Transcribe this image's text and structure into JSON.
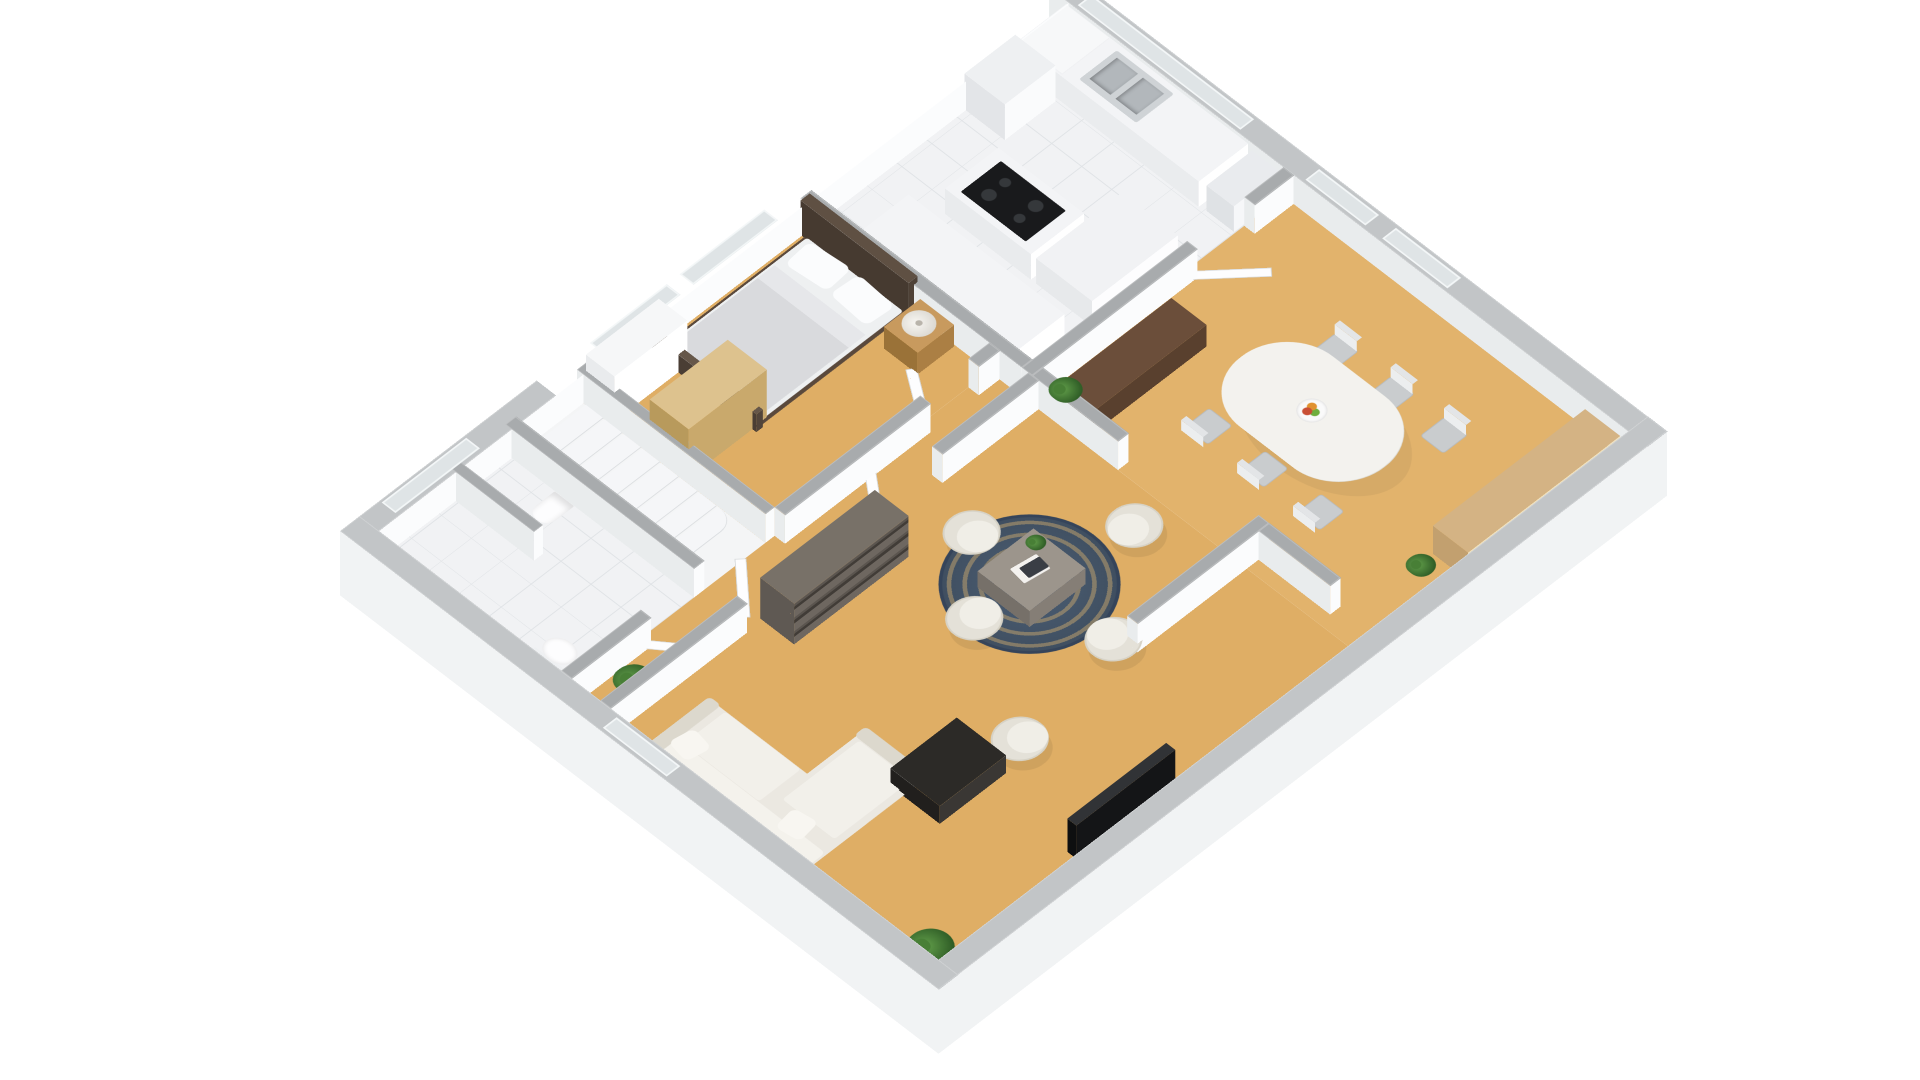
{
  "meta": {
    "view": "isometric-3d-floor-plan",
    "background": "#ffffff"
  },
  "palette": {
    "wood": "#dfae65",
    "wood2": "#e2b36c",
    "tile": "#f1f2f4",
    "tile_line": "#e0e3e6",
    "cap_int": "#a8abad",
    "cap_ext": "#c2c5c7",
    "face_s": "#fbfcfd",
    "face_w": "#e9eced",
    "skirt": "#f1f3f4",
    "white": "#ffffff",
    "stair": "#f5f6f8",
    "stair_edge": "#d8dbde",
    "rug_base": "#3e4d5e",
    "rug_pattern": "#c7a66e",
    "sofa": "#ebe8e1",
    "sofa_light": "#f2f0ea",
    "sofa_shade": "#dcd8cd",
    "armchair": "#e4e1d8",
    "armchair_seat": "#f0eee7",
    "oak_light": "#ddc28e",
    "oak_mid": "#c89a5e",
    "walnut_dark": "#5e4a38",
    "shelf_gray": "#787168",
    "table_gray": "#9c958c",
    "black_wood": "#2c2a27",
    "tv_dark": "#141517",
    "steel": "#cfd3d6",
    "steel_dark": "#b2b7bb",
    "cooktop": "#191a1c",
    "plant_green": "#63a04b",
    "plant_dark": "#2f5d26",
    "dining_white": "#f3f2ee",
    "chair_gray": "#c9ccce",
    "door_white": "#fdfdfe"
  },
  "rooms": [
    {
      "n": "wc-floor",
      "x": 30,
      "y": 20,
      "w": 204,
      "h": 290,
      "f": "tile"
    },
    {
      "n": "stair-floor",
      "x": 234,
      "y": 20,
      "w": 110,
      "h": 290,
      "f": "plain"
    },
    {
      "n": "bedroom-floor",
      "x": 344,
      "y": 20,
      "w": 344,
      "h": 290,
      "f": "wood"
    },
    {
      "n": "kitchen-floor",
      "x": 688,
      "y": 20,
      "w": 402,
      "h": 340,
      "f": "tile"
    },
    {
      "n": "hall-living-floor",
      "x": 30,
      "y": 310,
      "w": 658,
      "h": 580,
      "f": "wood"
    },
    {
      "n": "dining-floor",
      "x": 688,
      "y": 360,
      "w": 402,
      "h": 530,
      "f": "wood2"
    }
  ],
  "walls": [
    {
      "n": "wall-north",
      "x": 0,
      "y": 0,
      "w": 1120,
      "h": 30,
      "t": "e",
      "s": 1,
      "wf": 2
    },
    {
      "n": "wall-east",
      "x": 1090,
      "y": 0,
      "w": 30,
      "h": 920,
      "t": "e",
      "s": 2,
      "wf": 1
    },
    {
      "n": "wall-south",
      "x": 0,
      "y": 890,
      "w": 1120,
      "h": 30,
      "t": "e",
      "s": 2,
      "wf": 0
    },
    {
      "n": "wall-west",
      "x": 0,
      "y": 0,
      "w": 30,
      "h": 920,
      "t": "e",
      "s": 0,
      "wf": 2
    },
    {
      "n": "wall-wc-stairs",
      "x": 234,
      "y": 20,
      "w": 16,
      "h": 290,
      "t": "i",
      "s": 1,
      "wf": 1
    },
    {
      "n": "wall-stairs-bedroom",
      "x": 344,
      "y": 20,
      "w": 14,
      "h": 290,
      "t": "i",
      "s": 1,
      "wf": 1
    },
    {
      "n": "wall-bedroom-kitchen",
      "x": 688,
      "y": 20,
      "w": 16,
      "h": 340,
      "t": "i",
      "s": 1,
      "wf": 1
    },
    {
      "n": "wall-wc-south",
      "x": 30,
      "y": 310,
      "w": 122,
      "h": 16,
      "t": "i",
      "s": 1,
      "wf": 1
    },
    {
      "n": "wall-bedroom-south-a",
      "x": 358,
      "y": 310,
      "w": 224,
      "h": 16,
      "t": "i",
      "s": 1,
      "wf": 1
    },
    {
      "n": "wall-bedroom-south-b",
      "x": 656,
      "y": 310,
      "w": 32,
      "h": 16,
      "t": "i",
      "s": 1,
      "wf": 1
    },
    {
      "n": "wall-hall-living-a",
      "x": 30,
      "y": 370,
      "w": 210,
      "h": 16,
      "t": "i",
      "s": 1,
      "wf": 1
    },
    {
      "n": "wall-hall-living-b",
      "x": 330,
      "y": 370,
      "w": 122,
      "h": 16,
      "t": "i",
      "s": 1,
      "wf": 1
    },
    {
      "n": "wall-hall-living-c",
      "x": 540,
      "y": 370,
      "w": 148,
      "h": 16,
      "t": "i",
      "s": 1,
      "wf": 1
    },
    {
      "n": "wall-kitchen-south-a",
      "x": 688,
      "y": 360,
      "w": 254,
      "h": 16,
      "t": "i",
      "s": 1,
      "wf": 1
    },
    {
      "n": "wall-kitchen-south-b",
      "x": 1030,
      "y": 360,
      "w": 60,
      "h": 16,
      "t": "i",
      "s": 1,
      "wf": 1
    },
    {
      "n": "wall-hall-dining",
      "x": 688,
      "y": 376,
      "w": 16,
      "h": 132,
      "t": "i",
      "s": 1,
      "wf": 1
    },
    {
      "n": "wall-partition-living",
      "x": 520,
      "y": 690,
      "w": 202,
      "h": 16,
      "t": "i",
      "s": 1,
      "wf": 1
    },
    {
      "n": "wall-partition-return",
      "x": 706,
      "y": 706,
      "w": 16,
      "h": 110,
      "t": "i",
      "s": 1,
      "wf": 1
    },
    {
      "n": "wall-wc-half",
      "x": 148,
      "y": 20,
      "w": 14,
      "h": 130,
      "t": "i",
      "s": 1,
      "wf": 1
    }
  ],
  "windows": [
    {
      "n": "window-wc",
      "x": 60,
      "y": 4,
      "w": 130,
      "h": 21
    },
    {
      "n": "window-bedroom-1",
      "x": 380,
      "y": 4,
      "w": 118,
      "h": 21
    },
    {
      "n": "window-bedroom-2",
      "x": 518,
      "y": 4,
      "w": 130,
      "h": 21
    },
    {
      "n": "window-kitchen",
      "x": 1094,
      "y": 40,
      "w": 21,
      "h": 250
    },
    {
      "n": "window-dining-1",
      "x": 1094,
      "y": 390,
      "w": 21,
      "h": 92
    },
    {
      "n": "window-dining-2",
      "x": 1094,
      "y": 508,
      "w": 21,
      "h": 100
    },
    {
      "n": "window-hall-west",
      "x": 4,
      "y": 400,
      "w": 21,
      "h": 98
    }
  ],
  "furniture": [
    {
      "n": "bedroom-closet",
      "k": "box",
      "x": 350,
      "y": 28,
      "w": 112,
      "h": 44,
      "z": 70,
      "cc": "#f6f7f8",
      "sc": "#ffffff",
      "wc": "#e9ebed"
    },
    {
      "n": "bed-frame",
      "k": "flat",
      "x": 452,
      "y": 34,
      "w": 246,
      "h": 156,
      "z": 2,
      "c": "#5a493c",
      "br": "4px"
    },
    {
      "n": "bed-mattress",
      "k": "flat",
      "x": 458,
      "y": 38,
      "w": 222,
      "h": 148,
      "z": 4,
      "c": "#eef0f1",
      "br": "4px"
    },
    {
      "n": "bed-blanket",
      "k": "flat",
      "x": 458,
      "y": 42,
      "w": 148,
      "h": 140,
      "z": 6,
      "c": "#d9dadd",
      "br": "2px"
    },
    {
      "n": "bed-blanket-fold",
      "k": "flat",
      "x": 600,
      "y": 42,
      "w": 26,
      "h": 140,
      "z": 6,
      "c": "#e6e7ea"
    },
    {
      "n": "bed-pillow-1",
      "k": "flat",
      "x": 636,
      "y": 48,
      "w": 42,
      "h": 60,
      "z": 8,
      "c": "#fbfcfd",
      "br": "9px",
      "r": -5
    },
    {
      "n": "bed-pillow-2",
      "k": "flat",
      "x": 636,
      "y": 116,
      "w": 42,
      "h": 60,
      "z": 8,
      "c": "#fbfcfd",
      "br": "9px",
      "r": 4
    },
    {
      "n": "bed-headboard",
      "k": "box",
      "x": 680,
      "y": 28,
      "w": 14,
      "h": 166,
      "z": 54,
      "cc": "#5f5043",
      "sc": "#4e4136",
      "wc": "#463a30"
    },
    {
      "n": "bed-footboard",
      "k": "box",
      "x": 448,
      "y": 32,
      "w": 10,
      "h": 160,
      "z": 28,
      "cc": "#665749",
      "sc": "#52453a",
      "wc": "#4a3e34"
    },
    {
      "n": "nightstand",
      "k": "box",
      "x": 630,
      "y": 206,
      "w": 56,
      "h": 52,
      "z": 34,
      "cc": "#c89a5e",
      "sc": "#ab7f44",
      "wc": "#9a7238"
    },
    {
      "n": "table-lamp",
      "k": "lamp",
      "x": 640,
      "y": 212,
      "w": 38,
      "h": 38,
      "z": 36
    },
    {
      "n": "wardrobe",
      "k": "box",
      "x": 350,
      "y": 126,
      "w": 120,
      "h": 60,
      "z": 76,
      "cc": "#ddc28e",
      "sc": "#c9a96c",
      "wc": "#b89a5c"
    },
    {
      "n": "kitchen-counter-east",
      "k": "box",
      "x": 1014,
      "y": 26,
      "w": 76,
      "h": 280,
      "z": 40,
      "cc": "#f3f4f6",
      "sc": "#ffffff",
      "wc": "#eaecee"
    },
    {
      "n": "washing-machine",
      "k": "box",
      "x": 1016,
      "y": 28,
      "w": 72,
      "h": 66,
      "z": 42,
      "cc": "#f7f8f9",
      "sc": "#f0f1f3",
      "wc": "washer"
    },
    {
      "n": "kitchen-sink",
      "k": "sink",
      "x": 1024,
      "y": 112,
      "w": 58,
      "h": 88,
      "z": 41
    },
    {
      "n": "kitchen-cabinet-north",
      "k": "box",
      "x": 932,
      "y": 28,
      "w": 78,
      "h": 62,
      "z": 56,
      "cc": "#eef0f2",
      "sc": "#fafbfc",
      "wc": "#e3e5e8"
    },
    {
      "n": "kitchen-island-a",
      "k": "box",
      "x": 812,
      "y": 118,
      "w": 82,
      "h": 132,
      "z": 40,
      "cc": "#f3f4f6",
      "sc": "#ffffff",
      "wc": "#e9ebed"
    },
    {
      "n": "cooktop",
      "k": "cooktop",
      "x": 820,
      "y": 134,
      "w": 62,
      "h": 100,
      "z": 41
    },
    {
      "n": "kitchen-island-b",
      "k": "box",
      "x": 812,
      "y": 258,
      "w": 132,
      "h": 86,
      "z": 40,
      "cc": "#f1f2f4",
      "sc": "#fdfdfe",
      "wc": "#e7e9eb"
    },
    {
      "n": "kitchenette-counter",
      "k": "box",
      "x": 704,
      "y": 96,
      "w": 74,
      "h": 240,
      "z": 40,
      "cc": "#f3f4f6",
      "sc": "#ffffff",
      "wc": "#e9ebed"
    },
    {
      "n": "kitchen-appliance-south",
      "k": "box",
      "x": 1016,
      "y": 316,
      "w": 70,
      "h": 42,
      "z": 40,
      "cc": "#e9ebee",
      "sc": "#f6f7f9",
      "wc": "#dfe2e5"
    },
    {
      "n": "console-table",
      "k": "box",
      "x": 708,
      "y": 398,
      "w": 172,
      "h": 54,
      "z": 34,
      "cc": "#6b4e3a",
      "sc": "#59402e",
      "wc": "#4e3828"
    },
    {
      "n": "plant-wall-end",
      "k": "plant",
      "x": 680,
      "y": 400,
      "w": 36,
      "z": 48
    },
    {
      "n": "dining-table-shadow",
      "k": "flat",
      "x": 812,
      "y": 516,
      "w": 150,
      "h": 222,
      "z": 1.4,
      "c": "rgba(0,0,0,0.05)",
      "br": "50%"
    },
    {
      "n": "dining-table",
      "k": "flat",
      "x": 806,
      "y": 508,
      "w": 142,
      "h": 220,
      "z": 30,
      "c": "#f3f2ee",
      "br": "70px",
      "sh": "0 1px 0 #dddcd6"
    },
    {
      "n": "fruit-bowl",
      "k": "bowl",
      "x": 860,
      "y": 600,
      "w": 34,
      "z": 31
    },
    {
      "n": "dining-chair-1",
      "k": "chair",
      "x": 772,
      "y": 528,
      "dir": "w"
    },
    {
      "n": "dining-chair-2",
      "k": "chair",
      "x": 772,
      "y": 614,
      "dir": "w"
    },
    {
      "n": "dining-chair-3",
      "k": "chair",
      "x": 772,
      "y": 700,
      "dir": "w"
    },
    {
      "n": "dining-chair-4",
      "k": "chair",
      "x": 944,
      "y": 550,
      "dir": "e"
    },
    {
      "n": "dining-chair-5",
      "k": "chair",
      "x": 944,
      "y": 636,
      "dir": "e"
    },
    {
      "n": "dining-chair-6",
      "k": "chair",
      "x": 944,
      "y": 718,
      "dir": "e"
    },
    {
      "n": "sideboard",
      "k": "box",
      "x": 846,
      "y": 834,
      "w": 234,
      "h": 54,
      "z": 44,
      "cc": "#d4b384",
      "sc": "#efe2c0",
      "wc": "#c2a06f"
    },
    {
      "n": "plant-dining",
      "k": "plant",
      "x": 808,
      "y": 822,
      "w": 32,
      "z": 3
    },
    {
      "n": "bookshelf",
      "k": "shelf",
      "x": 264,
      "y": 382,
      "w": 176,
      "h": 52,
      "z": 64,
      "cc": "#787168",
      "wc": "#5f5953"
    },
    {
      "n": "living-rug",
      "k": "rug",
      "x": 406,
      "y": 456,
      "w": 198,
      "z": 1.2
    },
    {
      "n": "coffee-table",
      "k": "box",
      "x": 462,
      "y": 518,
      "w": 86,
      "h": 80,
      "z": 26,
      "cc": "#9c958c",
      "sc": "#857e76",
      "wc": "#767069"
    },
    {
      "n": "magazines",
      "k": "flat",
      "x": 486,
      "y": 544,
      "w": 36,
      "h": 26,
      "z": 27.5,
      "c": "#f4f2ef",
      "r": 8,
      "br": "2px"
    },
    {
      "n": "magazine-dark",
      "k": "flat",
      "x": 494,
      "y": 550,
      "w": 28,
      "h": 18,
      "z": 28.2,
      "c": "#3a3e45",
      "r": 8,
      "br": "2px"
    },
    {
      "n": "plant-coffee-table",
      "k": "plant",
      "x": 524,
      "y": 524,
      "w": 22,
      "z": 27.5
    },
    {
      "n": "armchair-north",
      "k": "arm",
      "x": 472,
      "y": 436,
      "a": 90
    },
    {
      "n": "armchair-west",
      "k": "arm",
      "x": 388,
      "y": 524,
      "a": 0
    },
    {
      "n": "armchair-south",
      "k": "arm",
      "x": 474,
      "y": 652,
      "a": 270
    },
    {
      "n": "armchair-east",
      "k": "arm",
      "x": 604,
      "y": 554,
      "a": 180
    },
    {
      "n": "armchair-single",
      "k": "arm",
      "x": 302,
      "y": 680,
      "a": 35
    },
    {
      "n": "sofa-base",
      "k": "flat",
      "x": 50,
      "y": 426,
      "w": 92,
      "h": 246,
      "z": 4,
      "c": "#ebe8e1",
      "br": "6px"
    },
    {
      "n": "sofa-chaise",
      "k": "flat",
      "x": 50,
      "y": 576,
      "w": 182,
      "h": 96,
      "z": 4,
      "c": "#ebe8e1",
      "br": "6px"
    },
    {
      "n": "sofa-back",
      "k": "flat",
      "x": 50,
      "y": 426,
      "w": 24,
      "h": 246,
      "z": 8,
      "c": "#f4f2ec",
      "br": "6px"
    },
    {
      "n": "sofa-arm-north",
      "k": "flat",
      "x": 50,
      "y": 426,
      "w": 92,
      "h": 18,
      "z": 8,
      "c": "#dcd8cd",
      "br": "6px"
    },
    {
      "n": "sofa-arm-end",
      "k": "flat",
      "x": 214,
      "y": 576,
      "w": 18,
      "h": 96,
      "z": 8,
      "c": "#dcd8cd",
      "br": "6px"
    },
    {
      "n": "sofa-cushion-1",
      "k": "flat",
      "x": 76,
      "y": 452,
      "w": 64,
      "h": 116,
      "z": 6,
      "c": "#f2f0ea",
      "br": "4px"
    },
    {
      "n": "sofa-cushion-2",
      "k": "flat",
      "x": 96,
      "y": 584,
      "w": 118,
      "h": 80,
      "z": 6,
      "c": "#f2f0ea",
      "br": "4px"
    },
    {
      "n": "sofa-pillow-1",
      "k": "flat",
      "x": 60,
      "y": 444,
      "w": 34,
      "h": 34,
      "z": 10,
      "c": "#f8f6f1",
      "br": "8px",
      "r": 10
    },
    {
      "n": "sofa-pillow-2",
      "k": "flat",
      "x": 62,
      "y": 606,
      "w": 34,
      "h": 34,
      "z": 10,
      "c": "#f8f6f1",
      "br": "8px",
      "r": -8
    },
    {
      "n": "tv-stand",
      "k": "box",
      "x": 196,
      "y": 650,
      "w": 102,
      "h": 76,
      "z": 28,
      "cc": "#2c2a27",
      "sc": "#3a3734",
      "wc": "#211f1d"
    },
    {
      "n": "tv-screen",
      "k": "box",
      "x": 266,
      "y": 852,
      "w": 152,
      "h": 14,
      "z": 52,
      "cc": "#313336",
      "sc": "#141517",
      "wc": "#0e0f10"
    },
    {
      "n": "plant-living",
      "k": "plant",
      "x": 38,
      "y": 818,
      "w": 52,
      "z": 3
    },
    {
      "n": "plant-hall",
      "k": "plant",
      "x": 82,
      "y": 326,
      "w": 44,
      "z": 3
    },
    {
      "n": "bidet",
      "k": "flat",
      "x": 190,
      "y": 98,
      "w": 42,
      "h": 30,
      "z": 3,
      "c": "#fdfdfe",
      "br": "14px 2px 2px 14px",
      "sh": "inset -6px 0 8px rgba(0,0,0,0.12)"
    },
    {
      "n": "toilet-tank",
      "k": "flat",
      "x": 48,
      "y": 240,
      "w": 12,
      "h": 46,
      "z": 4,
      "c": "#eef0f2"
    },
    {
      "n": "toilet-bowl",
      "k": "flat",
      "x": 58,
      "y": 242,
      "w": 34,
      "h": 42,
      "z": 4,
      "c": "#fdfdfe",
      "br": "50%",
      "sh": "inset 0 0 6px rgba(0,0,0,0.12)"
    },
    {
      "n": "wc-door",
      "k": "door",
      "x": 150,
      "y": 314,
      "w": 78,
      "h": 11,
      "r": 52
    },
    {
      "n": "bedroom-door",
      "k": "door",
      "x": 584,
      "y": 306,
      "w": 72,
      "h": 11,
      "r": -56
    },
    {
      "n": "hall-door-1",
      "k": "door",
      "x": 248,
      "y": 366,
      "w": 82,
      "h": 11,
      "r": -48
    },
    {
      "n": "hall-door-2",
      "k": "door",
      "x": 452,
      "y": 366,
      "w": 84,
      "h": 11,
      "r": -52
    },
    {
      "n": "entry-door",
      "k": "door",
      "x": 34,
      "y": 556,
      "w": 11,
      "h": 84,
      "r": -44
    },
    {
      "n": "dining-door",
      "k": "door",
      "x": 944,
      "y": 368,
      "w": 84,
      "h": 11,
      "r": 42
    },
    {
      "n": "staircase",
      "k": "stairs",
      "x": 252,
      "y": 36,
      "w": 90,
      "steps": 8,
      "step_h": 26,
      "gap": 3
    }
  ]
}
